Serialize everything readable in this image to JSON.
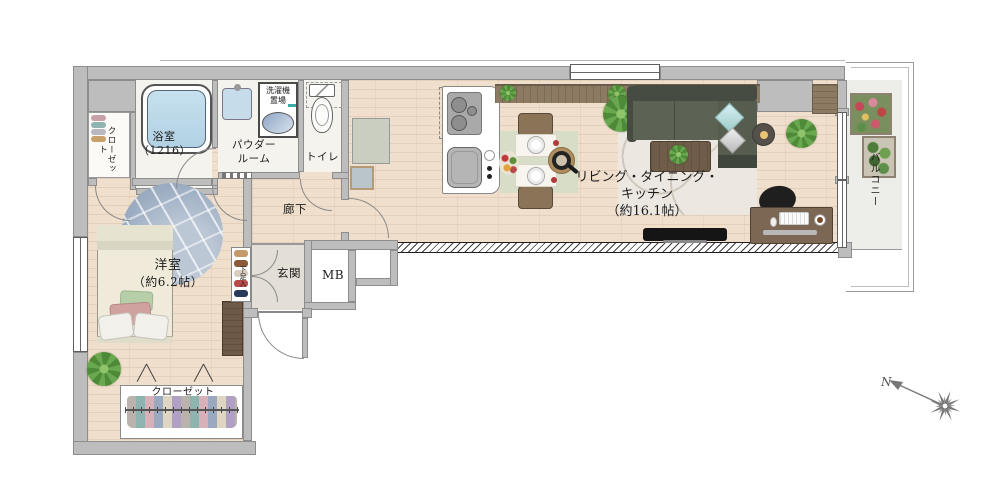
{
  "rooms": {
    "closet_left": {
      "label": "クローゼット"
    },
    "bathroom": {
      "name": "浴室",
      "size": "（1216）"
    },
    "powder_room": {
      "line1": "パウダー",
      "line2": "ルーム"
    },
    "laundry": {
      "line1": "洗濯機",
      "line2": "置場"
    },
    "toilet": {
      "label": "トイレ"
    },
    "hallway": {
      "label": "廊下"
    },
    "bedroom": {
      "name": "洋室",
      "size": "（約6.2帖）"
    },
    "bedroom_closet": {
      "label": "クローゼット"
    },
    "shoe_cabinet": {
      "label": "下足入"
    },
    "entrance": {
      "label": "玄関"
    },
    "meter_box": {
      "label": "MB"
    },
    "ldk": {
      "line1": "リビング・ダイニング・",
      "line2": "キッチン",
      "size": "（約16.1帖）"
    },
    "balcony": {
      "label": "バルコニー"
    }
  },
  "compass": {
    "north": "N"
  },
  "colors": {
    "wall": "#bdbdbd",
    "wood_floor": "#f0dfcc",
    "wet_floor": "#f4f3ee",
    "entrance_floor": "#e3dfd6",
    "balcony_floor": "#ededea",
    "rug_blue": "#9cadc2",
    "rug_cream": "#ece8e1",
    "sofa_green": "#5c6355",
    "counter_wood": "#8d7a63",
    "bath_water": "#c6e0ee",
    "plant_green": "#4e8a38",
    "tv_black": "#151515"
  }
}
